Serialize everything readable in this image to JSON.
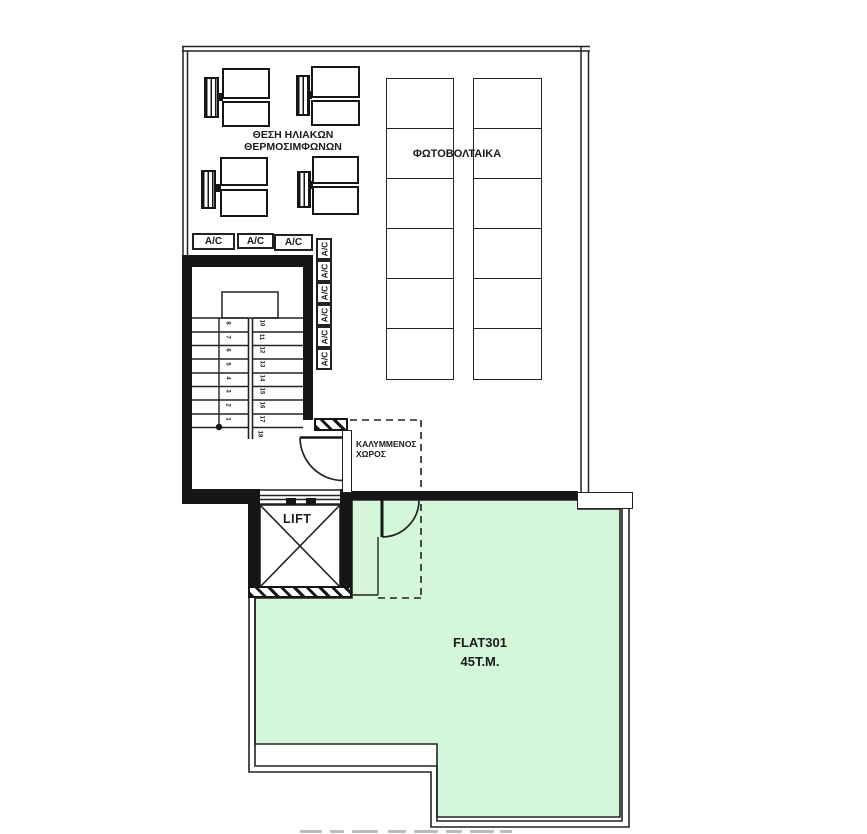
{
  "plan": {
    "colors": {
      "terrace_green": "#d4f7da",
      "line": "#1c1c1c"
    },
    "roof": {
      "solar_label_line1": "ΘΕΣΗ ΗΛΙΑΚΩΝ",
      "solar_label_line2": "ΘΕΡΜΟΣΙΜΦΩΝΩΝ",
      "photovoltaics_label": "ΦΩΤΟΒΟΛΤΑΙΚΑ",
      "ac_label": "A/C",
      "ac_horizontal_count": 3,
      "ac_vertical_count": 6
    },
    "core": {
      "lift_label": "LIFT",
      "stairs": {
        "left_numbers": [
          "8",
          "7",
          "6",
          "5",
          "4",
          "3",
          "2",
          "1"
        ],
        "right_numbers": [
          "10",
          "11",
          "12",
          "13",
          "14",
          "15",
          "16",
          "17"
        ],
        "bottom_number": "18"
      }
    },
    "terrace": {
      "covered_space_line1": "ΚΑΛΥΜΜΕΝΟΣ",
      "covered_space_line2": "ΧΩΡΟΣ",
      "flat_name": "FLAT301",
      "flat_area": "45T.M."
    }
  }
}
